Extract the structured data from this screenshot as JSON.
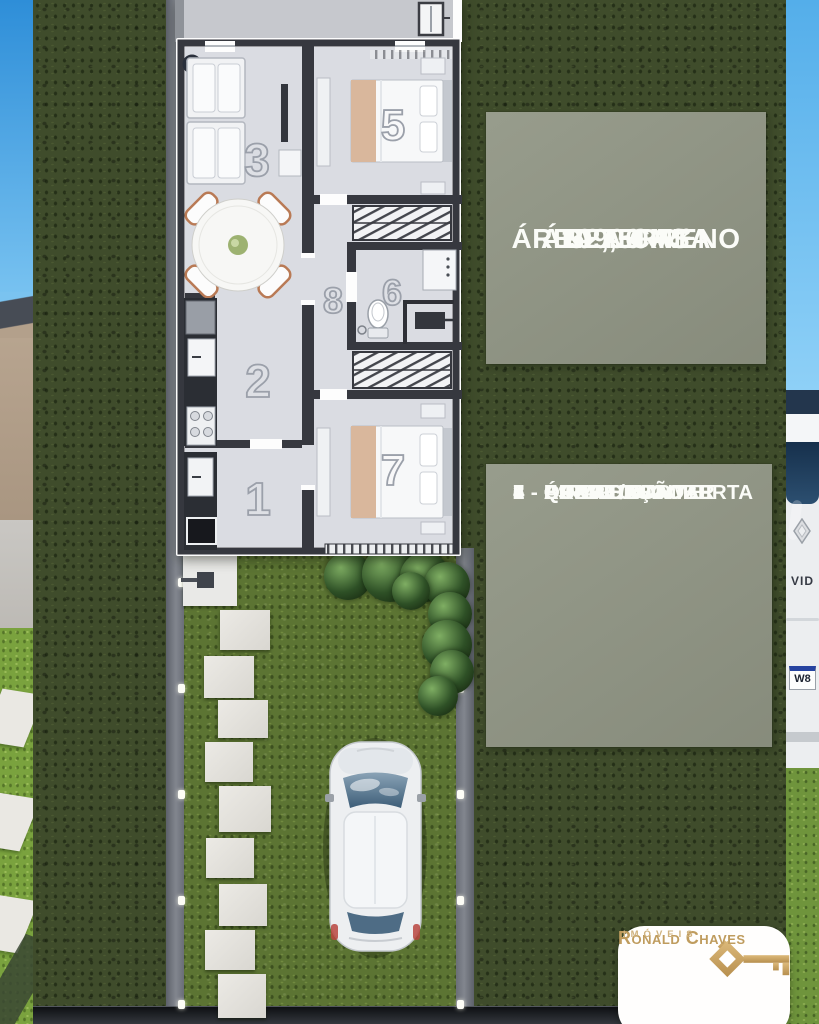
{
  "panels": {
    "terrain_label": "ÁREA TERRENO",
    "terrain_value": "109,50 M²",
    "house_label": "ÁREA CASA",
    "house_value": "52,00 M²"
  },
  "legend": {
    "items": [
      "1 - ÁREA GOURMET",
      "2 - COZINHA",
      "3 - ESTAR / JANTAR",
      "4 - ÁREA DESCOBERTA",
      "5 - QUARTO 01",
      "6 - BANHEIRO",
      "7 - QUARTO 02",
      "8 - CIRCULAÇÃO"
    ]
  },
  "plan_numbers": [
    {
      "num": "4"
    },
    {
      "num": "3"
    },
    {
      "num": "5"
    },
    {
      "num": "8"
    },
    {
      "num": "6"
    },
    {
      "num": "2"
    },
    {
      "num": "1"
    },
    {
      "num": "7"
    }
  ],
  "branding": {
    "name": "Ronald Chaves",
    "subtitle": "IMÓVEIS"
  },
  "background_photo": {
    "van_text": "VID",
    "van_plate": "W8"
  },
  "icons": [
    "key-house-icon",
    "car-top-view-icon",
    "renault-diamond-icon"
  ],
  "colors": {
    "panel_sage": "#919685",
    "terrain_green": "#3f4c2b",
    "yard_green": "#5c7433",
    "brand_gold": "#bf9c5e",
    "plan_floor": "#dadce2",
    "plan_wall": "#36383f"
  }
}
